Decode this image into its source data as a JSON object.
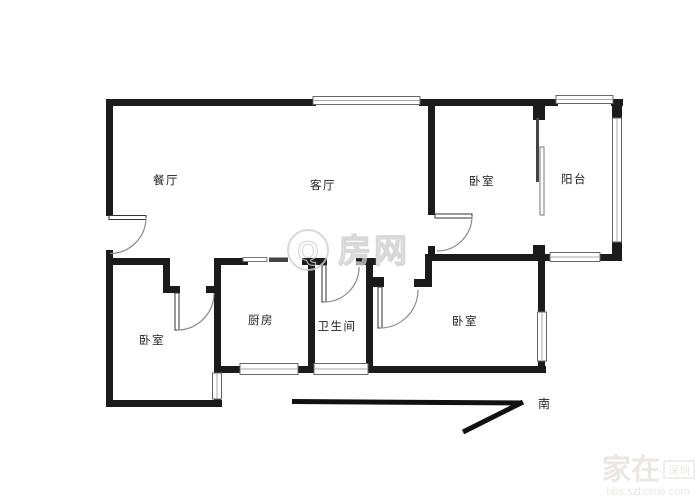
{
  "rooms": {
    "dining": "餐厅",
    "living": "客厅",
    "bedroom_top": "卧室",
    "balcony": "阳台",
    "bedroom_left": "卧室",
    "kitchen": "厨房",
    "bathroom": "卫生间",
    "bedroom_right": "卧室"
  },
  "compass": {
    "south": "南"
  },
  "watermarks": {
    "center_q": "Q",
    "center_text": "房网",
    "corner_brand": "家在",
    "corner_badge": "深圳",
    "corner_url": "bbs.szhome.com"
  },
  "colors": {
    "wall": "#1b1b1b",
    "label": "#222222",
    "center_watermark": "#cfcfcf",
    "corner_watermark": "#eae7e4"
  }
}
